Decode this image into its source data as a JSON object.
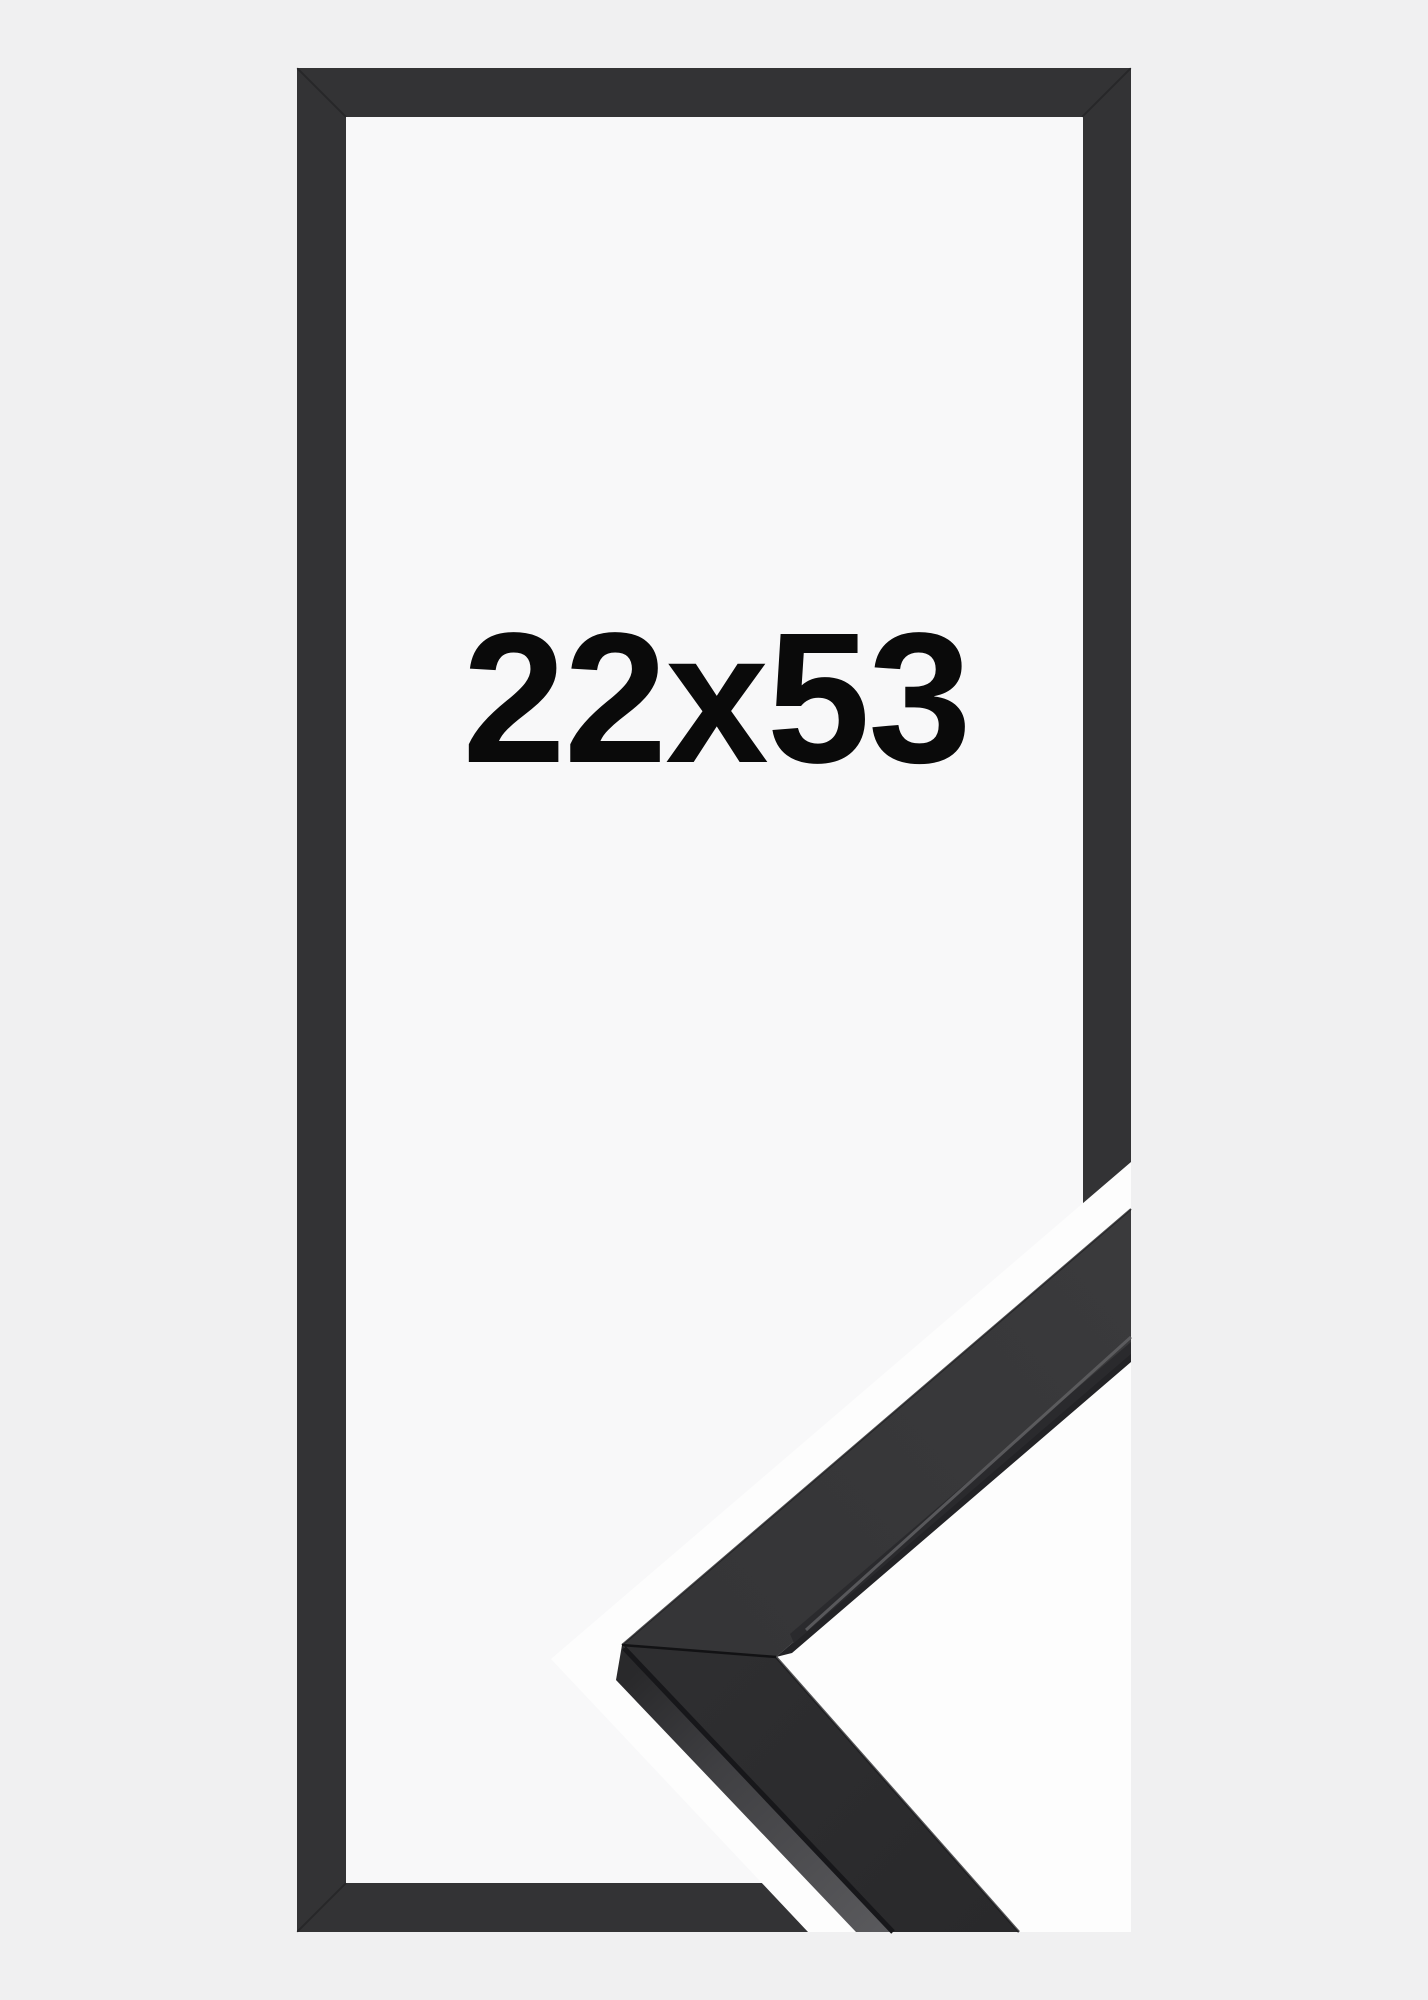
{
  "product_image": {
    "size_label": "22x53",
    "colors": {
      "page_background": "#f0f0f1",
      "frame": "#333335",
      "opening_background": "#f8f8f9",
      "label_text": "#0a0a0a",
      "detail_background": "#fdfdfd",
      "moulding_face_upper": "#3a3a3c",
      "moulding_bevel_strip": "#232326",
      "moulding_face_lower": "#2e2e30",
      "moulding_side_top": "#29292b",
      "moulding_side_bottom": "#59595c",
      "moulding_edge_line": "#17171a",
      "moulding_bevel_highlight": "#646467",
      "mitre_seam": "#121214"
    }
  }
}
